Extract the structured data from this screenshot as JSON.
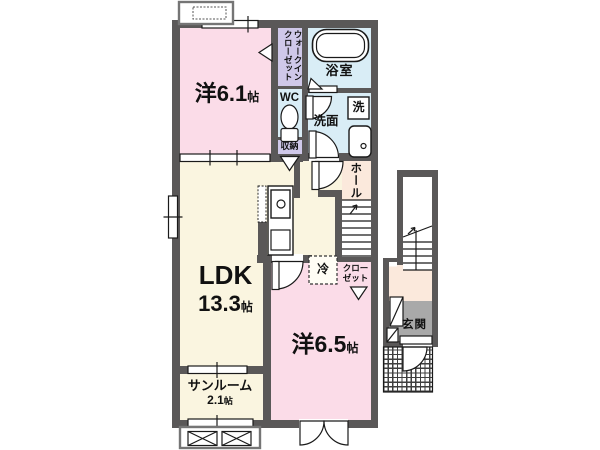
{
  "title": "apartment-floorplan",
  "rooms": {
    "bedroom1": {
      "name": "洋6.1",
      "unit": "帖"
    },
    "walk_in_closet": {
      "line1": "ウォークイン",
      "line2": "クローゼット"
    },
    "wc": {
      "name": "WC"
    },
    "bathroom": {
      "name": "浴室"
    },
    "washroom": {
      "name": "洗面"
    },
    "washer": {
      "name": "洗"
    },
    "storage": {
      "name": "収納"
    },
    "hall": {
      "name": "ホール"
    },
    "ldk": {
      "name": "LDK",
      "size": "13.3",
      "unit": "帖"
    },
    "refrigerator": {
      "name": "冷"
    },
    "closet": {
      "line1": "クロー",
      "line2": "ゼット"
    },
    "bedroom2": {
      "name": "洋6.5",
      "unit": "帖"
    },
    "sunroom": {
      "name": "サンルーム",
      "size": "2.1",
      "unit": "帖"
    },
    "entrance": {
      "name": "玄関"
    }
  },
  "colors": {
    "wall": "#5a5858",
    "bedroom_pink": "#fbdce8",
    "ldk_cream": "#faf5e0",
    "wet_blue": "#d9edf6",
    "closet_lavender": "#cfc8e9",
    "hall_peach": "#fbe9dc",
    "entrance_gray": "#a9a9a9"
  }
}
